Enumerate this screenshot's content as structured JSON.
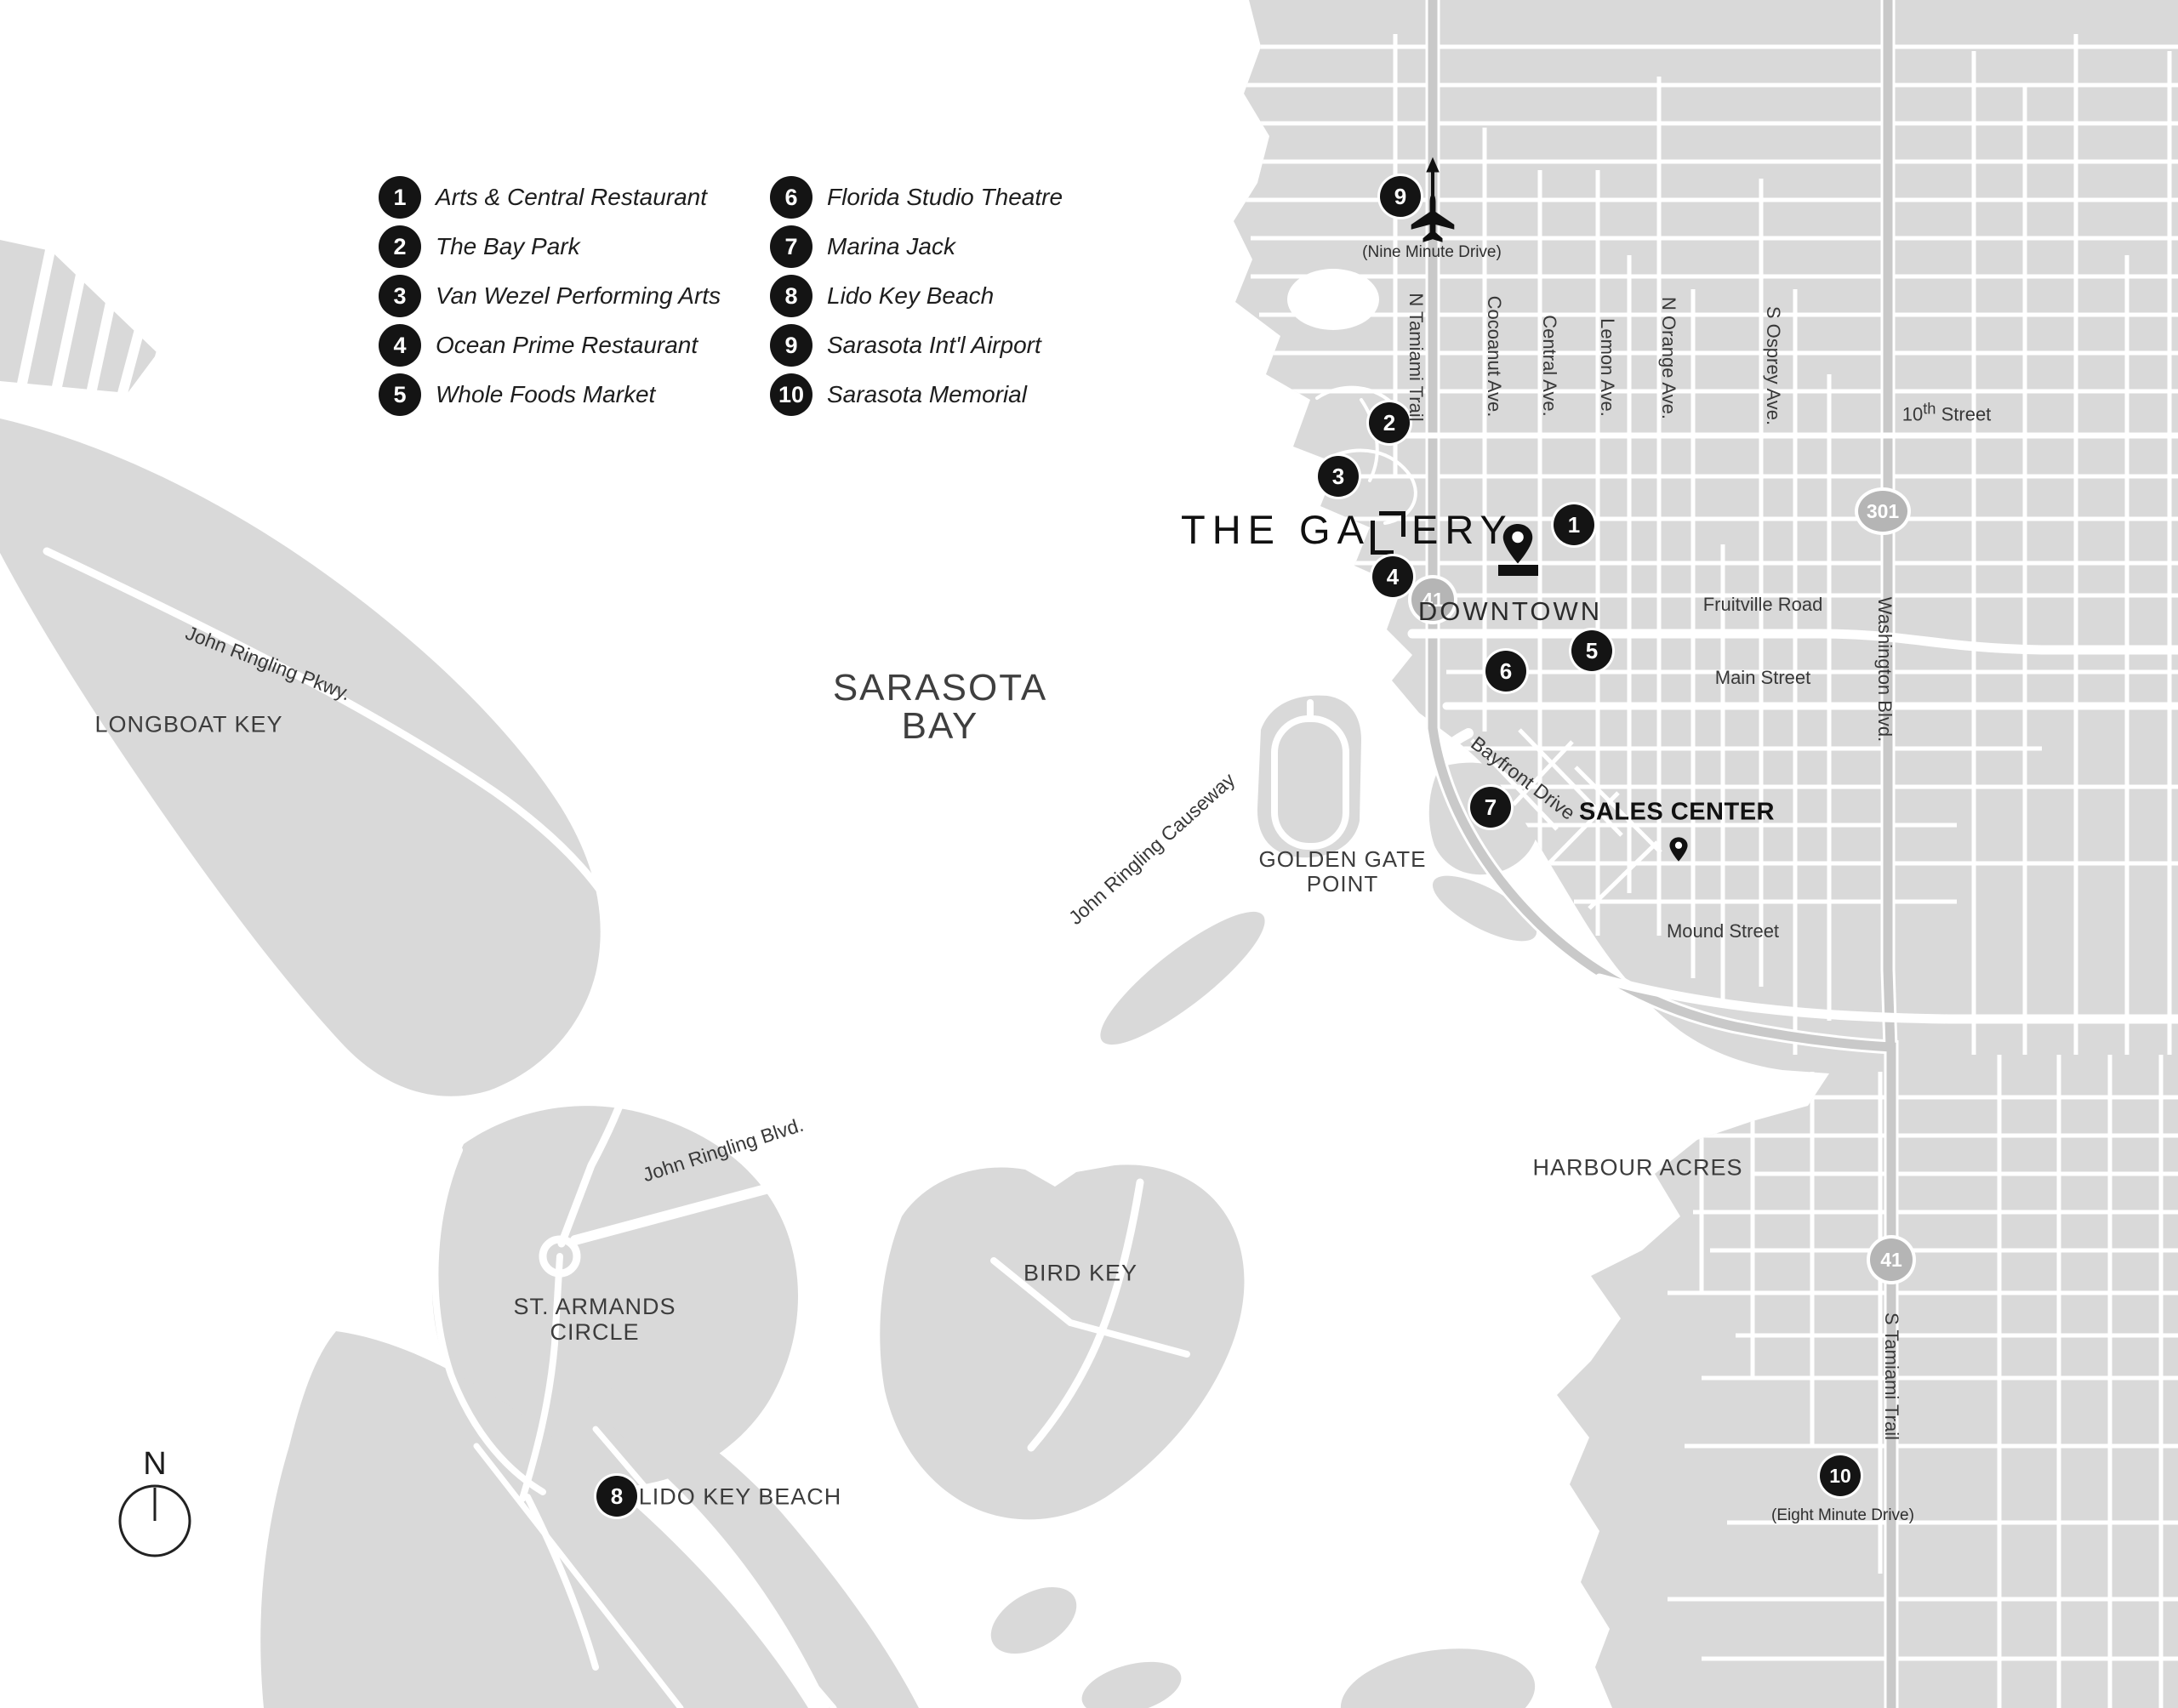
{
  "legend": {
    "items": [
      {
        "num": "1",
        "label": "Arts & Central Restaurant"
      },
      {
        "num": "2",
        "label": "The Bay Park"
      },
      {
        "num": "3",
        "label": "Van Wezel Performing Arts"
      },
      {
        "num": "4",
        "label": "Ocean Prime Restaurant"
      },
      {
        "num": "5",
        "label": "Whole Foods Market"
      },
      {
        "num": "6",
        "label": "Florida Studio Theatre"
      },
      {
        "num": "7",
        "label": "Marina Jack"
      },
      {
        "num": "8",
        "label": "Lido Key Beach"
      },
      {
        "num": "9",
        "label": "Sarasota Int'l Airport"
      },
      {
        "num": "10",
        "label": "Sarasota Memorial"
      }
    ]
  },
  "logo": {
    "part1": "THE GA",
    "part2": "ERY"
  },
  "map": {
    "areas": {
      "sarasota_bay_1": "SARASOTA",
      "sarasota_bay_2": "BAY",
      "longboat_key": "LONGBOAT KEY",
      "st_armands_1": "ST. ARMANDS",
      "st_armands_2": "CIRCLE",
      "bird_key": "BIRD KEY",
      "golden_gate_1": "GOLDEN GATE",
      "golden_gate_2": "POINT",
      "downtown": "DOWNTOWN",
      "harbour_acres": "HARBOUR ACRES",
      "lido_key_beach": "LIDO KEY BEACH"
    },
    "streets": {
      "john_ringling_pkwy": "John Ringling Pkwy.",
      "john_ringling_causeway": "John Ringling Causeway",
      "john_ringling_blvd": "John Ringling Blvd.",
      "n_tamiami": "N Tamiami Trail",
      "cocoanut": "Cocoanut Ave.",
      "central": "Central Ave.",
      "lemon": "Lemon Ave.",
      "n_orange": "N Orange Ave.",
      "s_osprey": "S Osprey Ave.",
      "tenth_num": "10",
      "tenth_sup": "th",
      "tenth_rest": " Street",
      "fruitville": "Fruitville Road",
      "main": "Main Street",
      "mound": "Mound Street",
      "washington": "Washington Blvd.",
      "s_tamiami": "S Tamiami Trail",
      "bayfront": "Bayfront Drive"
    },
    "shields": {
      "us41": "41",
      "us301": "301"
    },
    "sales_center": "SALES CENTER",
    "notes": {
      "airport_drive": "(Nine Minute Drive)",
      "memorial_drive": "(Eight Minute Drive)"
    },
    "markers": {
      "m1": "1",
      "m2": "2",
      "m3": "3",
      "m4": "4",
      "m5": "5",
      "m6": "6",
      "m7": "7",
      "m8": "8",
      "m9": "9",
      "m10": "10"
    },
    "compass_n": "N"
  },
  "colors": {
    "land": "#d9d9d9",
    "water": "#ffffff",
    "road": "#ffffff",
    "highway": "#c9c9c9",
    "shield": "#b5b5b5",
    "marker_bg": "#141414",
    "text_dark": "#1d1d1d"
  }
}
